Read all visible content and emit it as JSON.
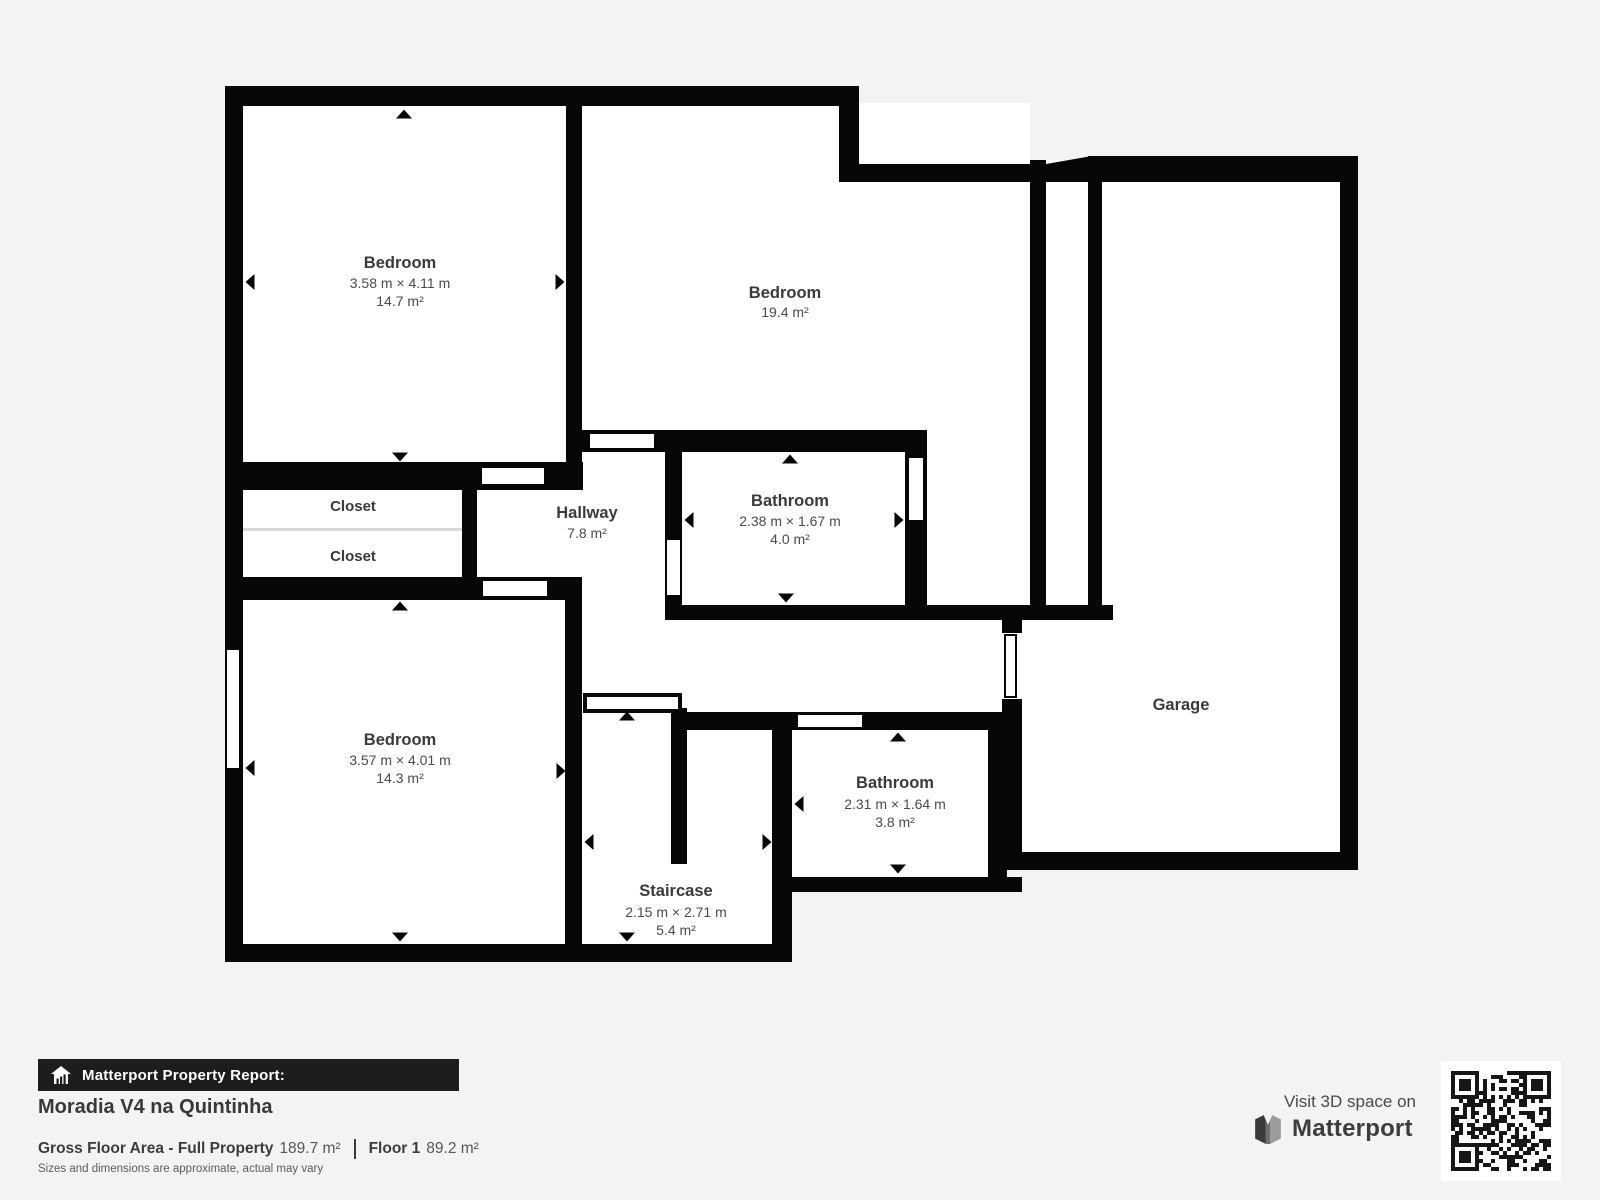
{
  "plan": {
    "rooms": [
      {
        "id": "bedroom-1",
        "name": "Bedroom",
        "dims": "3.58 m × 4.11 m",
        "area": "14.7 m²"
      },
      {
        "id": "bedroom-2",
        "name": "Bedroom",
        "dims": "",
        "area": "19.4 m²"
      },
      {
        "id": "closet-1",
        "name": "Closet"
      },
      {
        "id": "closet-2",
        "name": "Closet"
      },
      {
        "id": "hallway",
        "name": "Hallway",
        "dims": "",
        "area": "7.8 m²"
      },
      {
        "id": "bathroom-1",
        "name": "Bathroom",
        "dims": "2.38 m × 1.67 m",
        "area": "4.0 m²"
      },
      {
        "id": "bedroom-3",
        "name": "Bedroom",
        "dims": "3.57 m × 4.01 m",
        "area": "14.3 m²"
      },
      {
        "id": "staircase",
        "name": "Staircase",
        "dims": "2.15 m × 2.71 m",
        "area": "5.4 m²"
      },
      {
        "id": "bathroom-2",
        "name": "Bathroom",
        "dims": "2.31 m × 1.64 m",
        "area": "3.8 m²"
      },
      {
        "id": "garage",
        "name": "Garage"
      }
    ]
  },
  "footer": {
    "report_label": "Matterport Property Report:",
    "property_name": "Moradia V4 na Quintinha",
    "gfa_label": "Gross Floor Area - Full Property",
    "gfa_value": "189.7 m²",
    "floor_label": "Floor 1",
    "floor_value": "89.2 m²",
    "disclaimer": "Sizes and dimensions are approximate, actual may vary",
    "visit_label": "Visit 3D space on",
    "brand": "Matterport"
  },
  "icons": {
    "house": "house-chart-icon",
    "logo": "matterport-logo-icon",
    "qr": "qr-code"
  },
  "colors": {
    "background": "#f4f3f1",
    "wall": "#070707",
    "room_fill": "#ffffff",
    "label": "#3a3a3a",
    "dim_text": "#4a4a4a",
    "bar_bg": "#1d1d1d",
    "qr": "#161616"
  }
}
